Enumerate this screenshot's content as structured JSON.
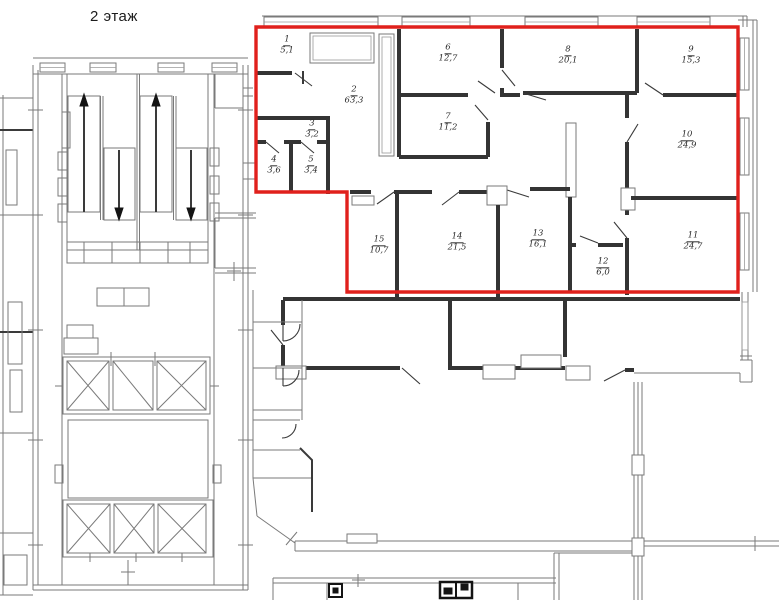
{
  "title": "2 этаж",
  "colors": {
    "highlight": "#e0201c",
    "walls": "#343434"
  },
  "rooms": [
    {
      "num": "1",
      "area": "5,1"
    },
    {
      "num": "2",
      "area": "63,3"
    },
    {
      "num": "3",
      "area": "3,2"
    },
    {
      "num": "4",
      "area": "3,6"
    },
    {
      "num": "5",
      "area": "3,4"
    },
    {
      "num": "6",
      "area": "12,7"
    },
    {
      "num": "7",
      "area": "11,2"
    },
    {
      "num": "8",
      "area": "20,1"
    },
    {
      "num": "9",
      "area": "15,3"
    },
    {
      "num": "10",
      "area": "24,9"
    },
    {
      "num": "11",
      "area": "24,7"
    },
    {
      "num": "12",
      "area": "6,0"
    },
    {
      "num": "13",
      "area": "16,1"
    },
    {
      "num": "14",
      "area": "21,5"
    },
    {
      "num": "15",
      "area": "10,7"
    }
  ]
}
